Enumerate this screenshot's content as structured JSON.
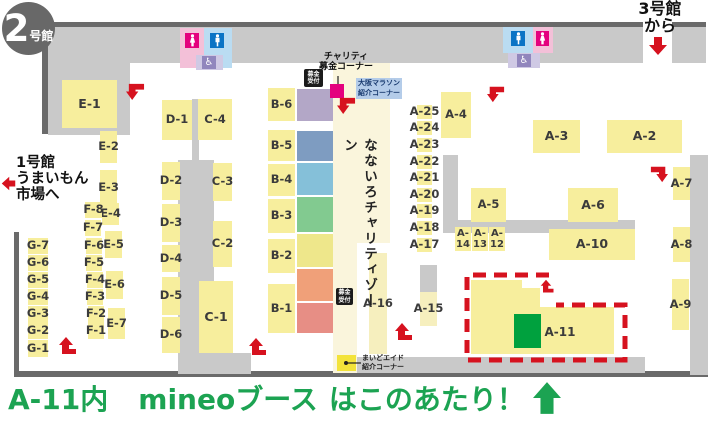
{
  "badge": {
    "number": "2",
    "suffix": "号館"
  },
  "annotations": {
    "hall3_line1": "3号館",
    "hall3_line2": "から",
    "hall1_line1": "1号館",
    "hall1_line2": "うまいもん",
    "hall1_line3": "市場へ",
    "charity_line1": "チャリティ",
    "charity_line2": "募金コーナー",
    "marathon_line1": "大阪マラソン",
    "marathon_line2": "紹介コーナー",
    "donation_line1": "募金",
    "donation_line2": "受付",
    "nanairo_zone": "なないろチャリティゾーン",
    "maido_line1": "まいどエイド",
    "maido_line2": "紹介コーナー"
  },
  "caption": {
    "area": "A-11内",
    "brand": "mineoブース",
    "rest": "はこのあたり！"
  },
  "colors": {
    "booth_yellow": "#f7ee9d",
    "booth_pale": "#f6efbe",
    "gray": "#c9c9c9",
    "dark": "#6a6a6a",
    "cream": "#faf5dc",
    "red": "#d6121f",
    "magenta": "#e4017e",
    "green_booth": "#00a13e",
    "caption_green": "#1ca352",
    "marathon_bg": "#b4cce9",
    "marathon_text": "#17396e",
    "maido_yellow": "#f3e33a"
  },
  "map": {
    "gray_zones": [
      {
        "x": 48,
        "y": 27,
        "w": 595,
        "h": 36
      },
      {
        "x": 672,
        "y": 27,
        "w": 34,
        "h": 36
      },
      {
        "x": 48,
        "y": 27,
        "w": 82,
        "h": 108
      },
      {
        "x": 192,
        "y": 99,
        "w": 7,
        "h": 66
      },
      {
        "x": 178,
        "y": 160,
        "w": 36,
        "h": 200
      },
      {
        "x": 178,
        "y": 353,
        "w": 73,
        "h": 21
      },
      {
        "x": 443,
        "y": 155,
        "w": 15,
        "h": 78
      },
      {
        "x": 458,
        "y": 220,
        "w": 177,
        "h": 13
      },
      {
        "x": 420,
        "y": 265,
        "w": 17,
        "h": 28
      },
      {
        "x": 690,
        "y": 155,
        "w": 18,
        "h": 220
      },
      {
        "x": 355,
        "y": 357,
        "w": 290,
        "h": 16
      }
    ],
    "walls": [
      {
        "x": 48,
        "y": 22,
        "w": 595,
        "h": 5
      },
      {
        "x": 672,
        "y": 22,
        "w": 34,
        "h": 5
      },
      {
        "x": 42,
        "y": 27,
        "w": 6,
        "h": 107
      },
      {
        "x": 14,
        "y": 232,
        "w": 5,
        "h": 141
      },
      {
        "x": 14,
        "y": 371,
        "w": 694,
        "h": 6
      }
    ],
    "cream_zones": [
      {
        "x": 333,
        "y": 63,
        "w": 57,
        "h": 180
      },
      {
        "x": 333,
        "y": 243,
        "w": 24,
        "h": 130
      }
    ],
    "colored_blocks": [
      {
        "color": "#b3a7c7",
        "x": 297,
        "y": 89,
        "w": 36,
        "h": 32
      },
      {
        "color": "#7e9cc1",
        "x": 297,
        "y": 131,
        "w": 36,
        "h": 30
      },
      {
        "color": "#85c0d9",
        "x": 297,
        "y": 163,
        "w": 36,
        "h": 32
      },
      {
        "color": "#82ca90",
        "x": 297,
        "y": 197,
        "w": 36,
        "h": 35
      },
      {
        "color": "#eee78b",
        "x": 297,
        "y": 234,
        "w": 36,
        "h": 33
      },
      {
        "color": "#f0a079",
        "x": 297,
        "y": 269,
        "w": 36,
        "h": 32
      },
      {
        "color": "#e78e85",
        "x": 297,
        "y": 303,
        "w": 36,
        "h": 30
      }
    ],
    "booths": [
      {
        "id": "E-1",
        "x": 62,
        "y": 80,
        "w": 55,
        "h": 48,
        "big": true
      },
      {
        "id": "E-2",
        "x": 100,
        "y": 131,
        "w": 17,
        "h": 32
      },
      {
        "id": "E-3",
        "x": 100,
        "y": 170,
        "w": 17,
        "h": 35
      },
      {
        "id": "E-4",
        "x": 102,
        "y": 203,
        "w": 17,
        "h": 22
      },
      {
        "id": "E-5",
        "x": 105,
        "y": 231,
        "w": 17,
        "h": 27
      },
      {
        "id": "E-6",
        "x": 106,
        "y": 271,
        "w": 17,
        "h": 28
      },
      {
        "id": "E-7",
        "x": 108,
        "y": 308,
        "w": 17,
        "h": 31
      },
      {
        "id": "F-8",
        "x": 85,
        "y": 202,
        "w": 17,
        "h": 16
      },
      {
        "id": "F-7",
        "x": 85,
        "y": 220,
        "w": 16,
        "h": 16
      },
      {
        "id": "F-6",
        "x": 86,
        "y": 238,
        "w": 16,
        "h": 16
      },
      {
        "id": "F-5",
        "x": 86,
        "y": 255,
        "w": 16,
        "h": 16
      },
      {
        "id": "F-4",
        "x": 87,
        "y": 272,
        "w": 16,
        "h": 16
      },
      {
        "id": "F-3",
        "x": 87,
        "y": 289,
        "w": 16,
        "h": 16
      },
      {
        "id": "F-2",
        "x": 88,
        "y": 306,
        "w": 16,
        "h": 16
      },
      {
        "id": "F-1",
        "x": 88,
        "y": 322,
        "w": 16,
        "h": 17
      },
      {
        "id": "G-7",
        "x": 28,
        "y": 238,
        "w": 20,
        "h": 16
      },
      {
        "id": "G-6",
        "x": 28,
        "y": 255,
        "w": 20,
        "h": 16
      },
      {
        "id": "G-5",
        "x": 28,
        "y": 272,
        "w": 20,
        "h": 16
      },
      {
        "id": "G-4",
        "x": 28,
        "y": 289,
        "w": 20,
        "h": 16
      },
      {
        "id": "G-3",
        "x": 28,
        "y": 306,
        "w": 20,
        "h": 16
      },
      {
        "id": "G-2",
        "x": 28,
        "y": 322,
        "w": 20,
        "h": 17
      },
      {
        "id": "G-1",
        "x": 28,
        "y": 340,
        "w": 20,
        "h": 17
      },
      {
        "id": "D-1",
        "x": 162,
        "y": 100,
        "w": 30,
        "h": 40
      },
      {
        "id": "D-2",
        "x": 162,
        "y": 162,
        "w": 18,
        "h": 38
      },
      {
        "id": "D-3",
        "x": 162,
        "y": 204,
        "w": 18,
        "h": 38
      },
      {
        "id": "D-4",
        "x": 162,
        "y": 245,
        "w": 18,
        "h": 27
      },
      {
        "id": "D-5",
        "x": 162,
        "y": 277,
        "w": 18,
        "h": 38
      },
      {
        "id": "D-6",
        "x": 162,
        "y": 317,
        "w": 18,
        "h": 36
      },
      {
        "id": "C-4",
        "x": 198,
        "y": 99,
        "w": 34,
        "h": 41
      },
      {
        "id": "C-3",
        "x": 213,
        "y": 163,
        "w": 19,
        "h": 38
      },
      {
        "id": "C-2",
        "x": 213,
        "y": 221,
        "w": 19,
        "h": 46
      },
      {
        "id": "C-1",
        "x": 199,
        "y": 281,
        "w": 34,
        "h": 72,
        "big": true
      },
      {
        "id": "B-6",
        "x": 268,
        "y": 88,
        "w": 27,
        "h": 33
      },
      {
        "id": "B-5",
        "x": 268,
        "y": 130,
        "w": 27,
        "h": 31
      },
      {
        "id": "B-4",
        "x": 268,
        "y": 164,
        "w": 27,
        "h": 32
      },
      {
        "id": "B-3",
        "x": 268,
        "y": 199,
        "w": 27,
        "h": 34
      },
      {
        "id": "B-2",
        "x": 268,
        "y": 239,
        "w": 27,
        "h": 34
      },
      {
        "id": "B-1",
        "x": 268,
        "y": 284,
        "w": 27,
        "h": 49
      },
      {
        "id": "A-25",
        "x": 417,
        "y": 105,
        "w": 15,
        "h": 14
      },
      {
        "id": "A-24",
        "x": 417,
        "y": 121,
        "w": 15,
        "h": 14
      },
      {
        "id": "A-23",
        "x": 417,
        "y": 138,
        "w": 15,
        "h": 14
      },
      {
        "id": "A-22",
        "x": 417,
        "y": 155,
        "w": 15,
        "h": 14
      },
      {
        "id": "A-21",
        "x": 417,
        "y": 171,
        "w": 15,
        "h": 14
      },
      {
        "id": "A-20",
        "x": 417,
        "y": 188,
        "w": 15,
        "h": 14
      },
      {
        "id": "A-19",
        "x": 417,
        "y": 204,
        "w": 15,
        "h": 14
      },
      {
        "id": "A-18",
        "x": 417,
        "y": 221,
        "w": 15,
        "h": 14
      },
      {
        "id": "A-17",
        "x": 417,
        "y": 238,
        "w": 15,
        "h": 14
      },
      {
        "id": "A-4",
        "x": 441,
        "y": 92,
        "w": 30,
        "h": 46
      },
      {
        "id": "A-3",
        "x": 533,
        "y": 120,
        "w": 47,
        "h": 33,
        "big": true
      },
      {
        "id": "A-2",
        "x": 607,
        "y": 120,
        "w": 75,
        "h": 33,
        "big": true
      },
      {
        "id": "A-5",
        "x": 471,
        "y": 188,
        "w": 35,
        "h": 34
      },
      {
        "id": "A-6",
        "x": 568,
        "y": 188,
        "w": 50,
        "h": 34,
        "big": true
      },
      {
        "id": "A-14",
        "x": 455,
        "y": 227,
        "w": 16,
        "h": 24,
        "lines": [
          "A-",
          "14"
        ]
      },
      {
        "id": "A-13",
        "x": 472,
        "y": 227,
        "w": 16,
        "h": 24,
        "lines": [
          "A-",
          "13"
        ]
      },
      {
        "id": "A-12",
        "x": 489,
        "y": 227,
        "w": 16,
        "h": 24,
        "lines": [
          "A-",
          "12"
        ]
      },
      {
        "id": "A-10",
        "x": 549,
        "y": 229,
        "w": 86,
        "h": 31,
        "big": true
      },
      {
        "id": "A-7",
        "x": 673,
        "y": 167,
        "w": 17,
        "h": 33
      },
      {
        "id": "A-8",
        "x": 673,
        "y": 227,
        "w": 17,
        "h": 35
      },
      {
        "id": "A-9",
        "x": 672,
        "y": 279,
        "w": 17,
        "h": 51
      },
      {
        "id": "A-16",
        "x": 369,
        "y": 253,
        "w": 18,
        "h": 101,
        "pale": true
      },
      {
        "id": "A-15",
        "x": 420,
        "y": 292,
        "w": 17,
        "h": 34,
        "pale": true
      }
    ],
    "restroom_areas": [
      {
        "name": "restroom-pink-area-1",
        "x": 180,
        "y": 28,
        "w": 24,
        "h": 40,
        "bg": "#f3c0d8"
      },
      {
        "name": "restroom-blue-area-1",
        "x": 204,
        "y": 28,
        "w": 28,
        "h": 40,
        "bg": "#badcf2"
      },
      {
        "name": "restroom-wheelchair-area-1",
        "x": 196,
        "y": 55,
        "w": 27,
        "h": 15,
        "bg": "#cfc9e4"
      },
      {
        "name": "restroom-blue-area-2",
        "x": 503,
        "y": 27,
        "w": 30,
        "h": 26,
        "bg": "#badcf2"
      },
      {
        "name": "restroom-pink-area-2",
        "x": 533,
        "y": 27,
        "w": 20,
        "h": 26,
        "bg": "#f3c0d8"
      },
      {
        "name": "restroom-wheelchair-area-2",
        "x": 508,
        "y": 53,
        "w": 32,
        "h": 15,
        "bg": "#cfc9e4"
      }
    ],
    "restroom_icons": [
      {
        "glyph": "female",
        "x": 185,
        "y": 33,
        "w": 14,
        "h": 15,
        "bg": "#e4017e"
      },
      {
        "glyph": "male",
        "x": 210,
        "y": 33,
        "w": 14,
        "h": 15,
        "bg": "#0b74c5"
      },
      {
        "glyph": "wheelchair",
        "x": 202,
        "y": 56,
        "w": 14,
        "h": 13,
        "bg": "#9186bd"
      },
      {
        "glyph": "male",
        "x": 511,
        "y": 31,
        "w": 14,
        "h": 15,
        "bg": "#0b74c5"
      },
      {
        "glyph": "female",
        "x": 536,
        "y": 31,
        "w": 13,
        "h": 15,
        "bg": "#e4017e"
      },
      {
        "glyph": "wheelchair",
        "x": 517,
        "y": 54,
        "w": 14,
        "h": 13,
        "bg": "#9186bd"
      }
    ],
    "arrows": [
      {
        "type": "cornerDL",
        "x": 126,
        "y": 82,
        "s": 19,
        "name": "route-arrow-top-left"
      },
      {
        "type": "left",
        "x": 1,
        "y": 176,
        "s": 15,
        "name": "route-arrow-hall1"
      },
      {
        "type": "cornerDL",
        "x": 337,
        "y": 96,
        "s": 19,
        "name": "route-arrow-center-top"
      },
      {
        "type": "cornerDL",
        "x": 487,
        "y": 85,
        "s": 18,
        "name": "route-arrow-right-top"
      },
      {
        "type": "down",
        "x": 648,
        "y": 36,
        "s": 20,
        "name": "route-arrow-hall3"
      },
      {
        "type": "cornerDR",
        "x": 650,
        "y": 165,
        "s": 18,
        "name": "route-arrow-a7"
      },
      {
        "type": "upTR",
        "x": 394,
        "y": 322,
        "s": 20,
        "name": "route-arrow-a16"
      },
      {
        "type": "upTR",
        "x": 248,
        "y": 337,
        "s": 20,
        "name": "route-arrow-c1"
      },
      {
        "type": "upTR",
        "x": 58,
        "y": 336,
        "s": 20,
        "name": "route-arrow-g1"
      },
      {
        "type": "upTR",
        "x": 540,
        "y": 279,
        "s": 15,
        "name": "route-arrow-a11"
      }
    ],
    "highlight": {
      "label": "A-11",
      "polygon": "471,280 522,280 522,288 540,288 540,307 614,307 614,354 471,354",
      "green_rect": {
        "x": 514,
        "y": 314,
        "w": 27,
        "h": 34
      },
      "dash_path": "M549 275 H467 V360 H625 V305 H556"
    },
    "callout_lines": [
      {
        "x1": 338,
        "y1": 76,
        "x2": 338,
        "y2": 84
      },
      {
        "x1": 346,
        "y1": 363,
        "x2": 361,
        "y2": 363
      }
    ],
    "magenta_square": {
      "x": 330,
      "y": 84,
      "w": 14,
      "h": 14
    }
  }
}
